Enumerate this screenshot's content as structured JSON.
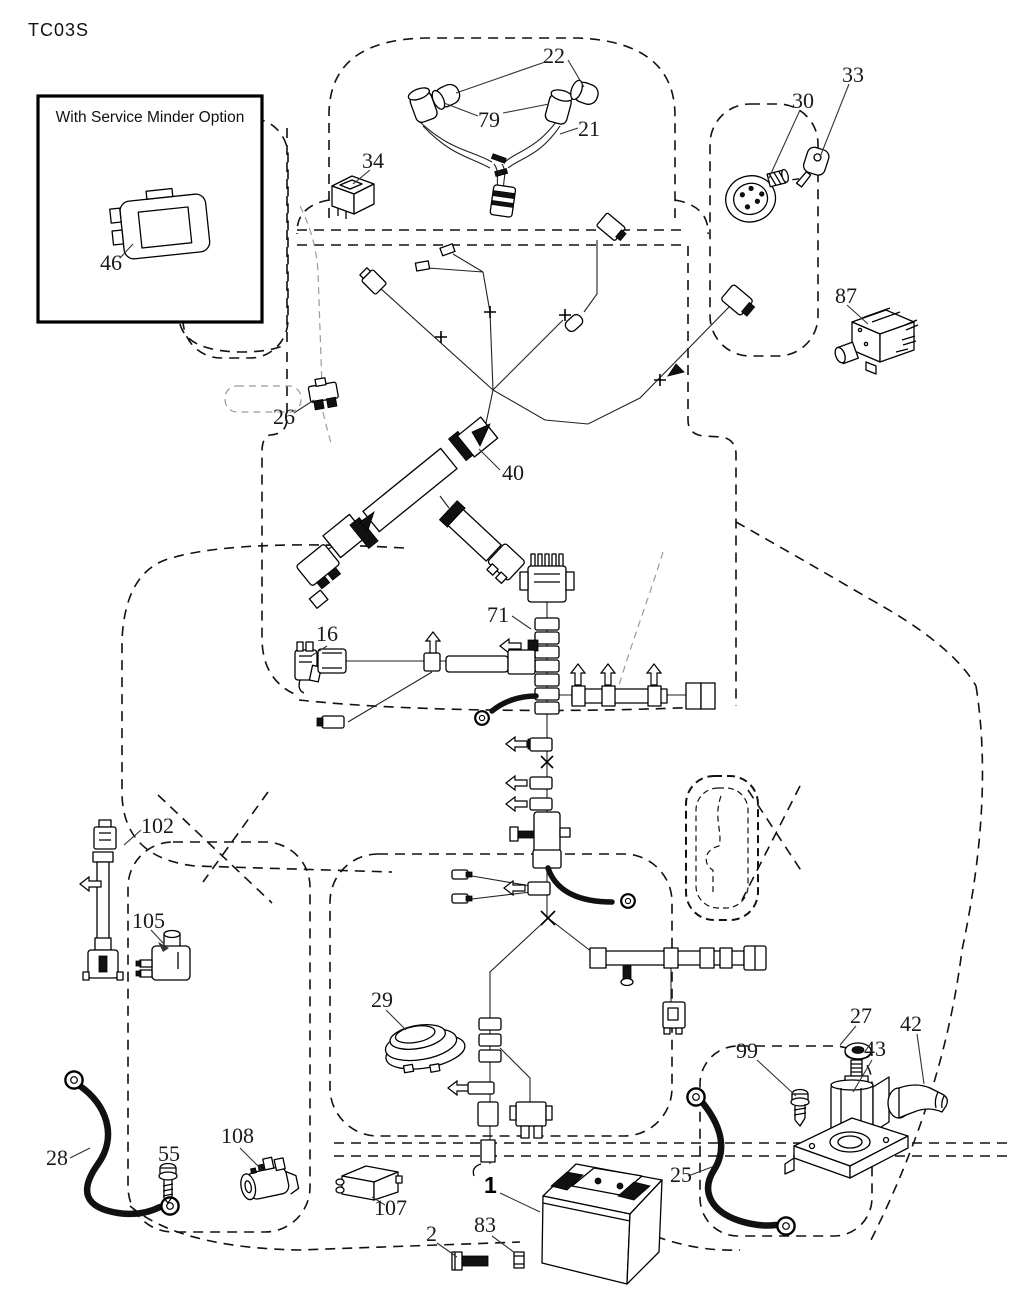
{
  "title": "TC03S",
  "inset": {
    "caption": "With Service Minder Option"
  },
  "labels": {
    "p1": "1",
    "p2": "2",
    "p16": "16",
    "p21": "21",
    "p22": "22",
    "p25": "25",
    "p26": "26",
    "p27": "27",
    "p28": "28",
    "p29": "29",
    "p30": "30",
    "p33": "33",
    "p34": "34",
    "p40": "40",
    "p42": "42",
    "p43": "43",
    "p46": "46",
    "p55": "55",
    "p71": "71",
    "p79": "79",
    "p83": "83",
    "p87": "87",
    "p99": "99",
    "p102": "102",
    "p105": "105",
    "p107": "107",
    "p108": "108"
  },
  "colors": {
    "line": "#000000",
    "background": "#ffffff",
    "cable": "#111111",
    "ghost": "#999999"
  }
}
